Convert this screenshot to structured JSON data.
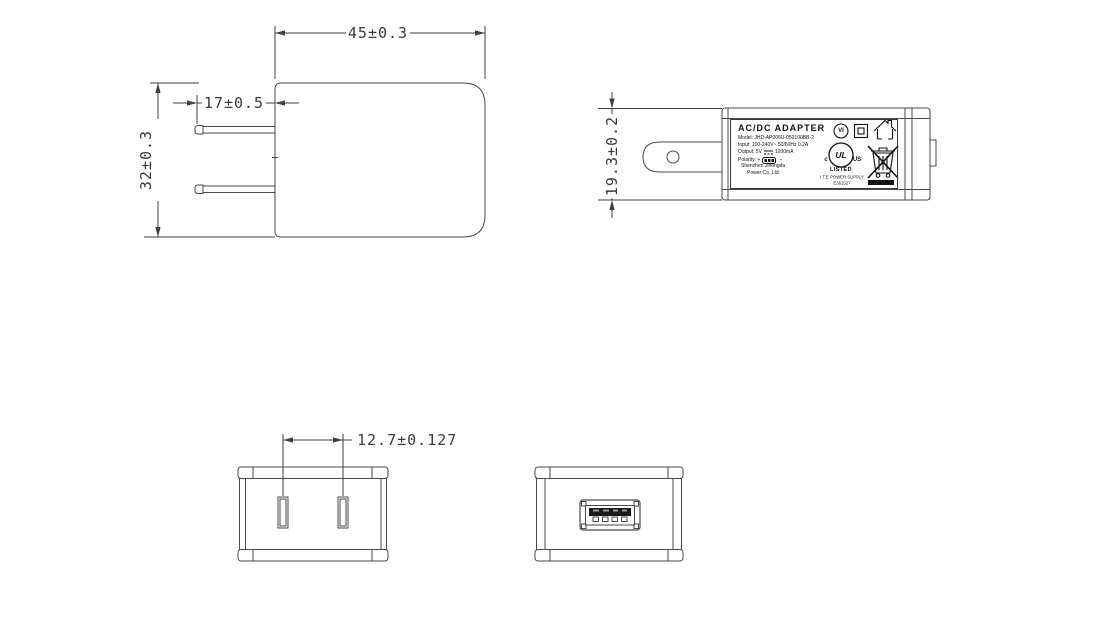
{
  "drawing_title": "AC/DC adapter dimension drawing",
  "views": {
    "front": {
      "dim_width": "45±0.3",
      "dim_pin_length": "17±0.5",
      "dim_height": "32±0.3"
    },
    "side": {
      "dim_height": "19.3±0.2"
    },
    "bottom_pins": {
      "dim_pin_spacing": "12.7±0.127"
    }
  },
  "label": {
    "title": "AC/DC  ADAPTER",
    "model_line": "Model: JHD-AP006U-050100BB-2",
    "input_line": "Input: 100-240V~  50/60Hz  0.2A",
    "output_prefix": "Output: 5V",
    "output_suffix": "1000mA",
    "polarity_prefix": "Polarity: +",
    "polarity_suffix": "−",
    "company_line_1": "Shenzhen Jihongda",
    "company_line_2": "Power Co.,Ltd.",
    "efficiency_mark": "VI",
    "ul_c": "c",
    "ul_logo": "UL",
    "ul_us": "US",
    "ul_listed": "LISTED",
    "ul_category": "I.T.E POWER SUPPLY",
    "ul_file_no": "E361527"
  },
  "colors": {
    "line": "#4a4a4a",
    "dim_text": "#3a3a3a",
    "label_ink": "#111111",
    "background": "#ffffff"
  }
}
